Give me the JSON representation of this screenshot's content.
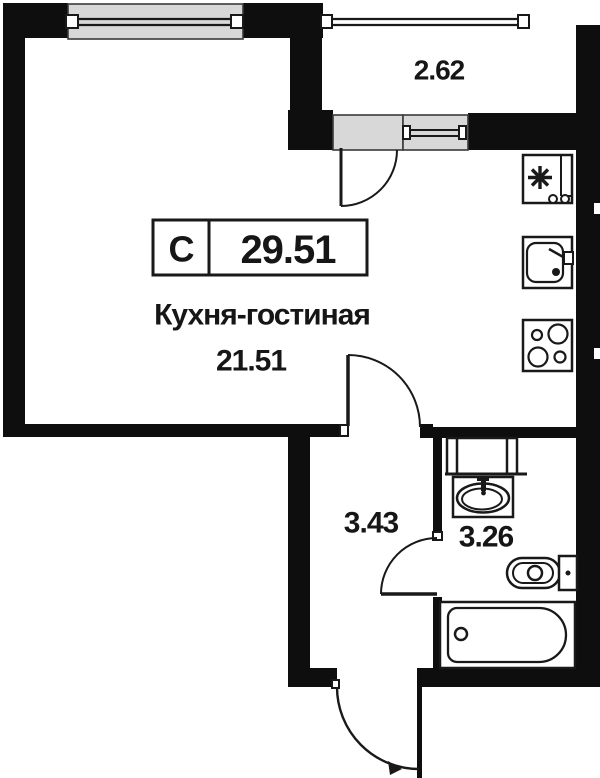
{
  "plaque": {
    "unit_type": "С",
    "total_area": "29.51"
  },
  "rooms": {
    "kitchen_living": {
      "name": "Кухня-гостиная",
      "area": "21.51"
    },
    "hallway": {
      "area": "3.43"
    },
    "bathroom": {
      "area": "3.26"
    },
    "balcony": {
      "area": "2.62"
    }
  },
  "icons": {
    "fridge_badge": "snowflake-icon"
  },
  "colors": {
    "wall": "#0e0e0e",
    "line": "#191919",
    "panel": "#d8d8d8",
    "text": "#161616",
    "bg": "#ffffff"
  }
}
